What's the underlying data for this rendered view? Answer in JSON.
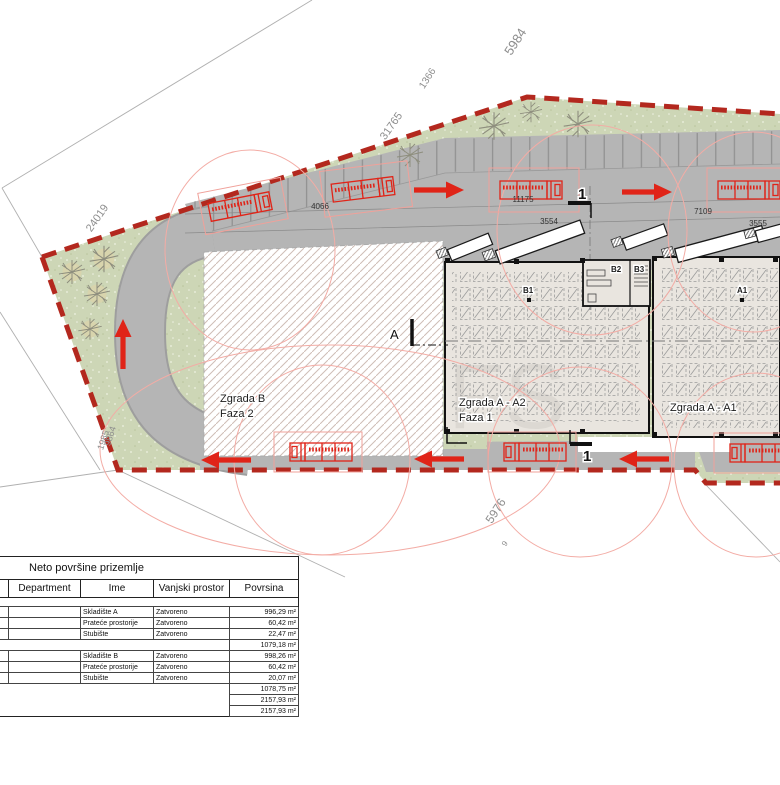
{
  "plan": {
    "dimensions": {
      "d5984": "5984",
      "d1366": "1366",
      "d31765": "31765",
      "d24019": "24019",
      "d1985": "1985",
      "d9864": "9864",
      "d4066": "4066",
      "d11175": "11175",
      "d7109": "7109",
      "d3554": "3554",
      "d3555": "3555",
      "d5976": "5976",
      "d9": "9"
    },
    "labels": {
      "zgrada_b": "Zgrada B",
      "faza_2": "Faza 2",
      "zgrada_a2": "Zgrada A - A2",
      "faza_1": "Faza 1",
      "zgrada_a1": "Zgrada A - A1",
      "room_b1": "B1",
      "room_b2": "B2",
      "room_b3": "B3",
      "room_a1": "A1",
      "section_top": "1",
      "section_bottom": "1",
      "section_a": "A",
      "watermark": "FS"
    },
    "colors": {
      "boundary_red": "#b3281e",
      "truck_red": "#e02418",
      "sweep_path_red": "#f3aca5",
      "green": "#cdd6b6",
      "road_gray": "#b5b5b5",
      "building_fill": "#e9e5df"
    }
  },
  "table": {
    "title": "Neto površine prizemlje",
    "headers": {
      "department": "Department",
      "ime": "Ime",
      "vanjski": "Vanjski prostor",
      "povrsina": "Povrsina"
    },
    "rows": [
      {
        "dept": "A",
        "ime": "Skladište A",
        "vanjski": "Zatvoreno",
        "povrsina": "996,29 m²"
      },
      {
        "dept": "A",
        "ime": "Prateće prostorije",
        "vanjski": "Zatvoreno",
        "povrsina": "60,42 m²"
      },
      {
        "dept": "A",
        "ime": "Stubište",
        "vanjski": "Zatvoreno",
        "povrsina": "22,47 m²"
      },
      {
        "dept": "B",
        "ime": "Skladište B",
        "vanjski": "Zatvoreno",
        "povrsina": "998,26 m²"
      },
      {
        "dept": "B",
        "ime": "Prateće prostorije",
        "vanjski": "Zatvoreno",
        "povrsina": "60,42 m²"
      },
      {
        "dept": "B",
        "ime": "Stubište",
        "vanjski": "Zatvoreno",
        "povrsina": "20,07 m²"
      }
    ],
    "subtotal_a": "1079,18 m²",
    "subtotal_b": "1078,75 m²",
    "total": "2157,93 m²",
    "grand_total": "2157,93 m²"
  }
}
